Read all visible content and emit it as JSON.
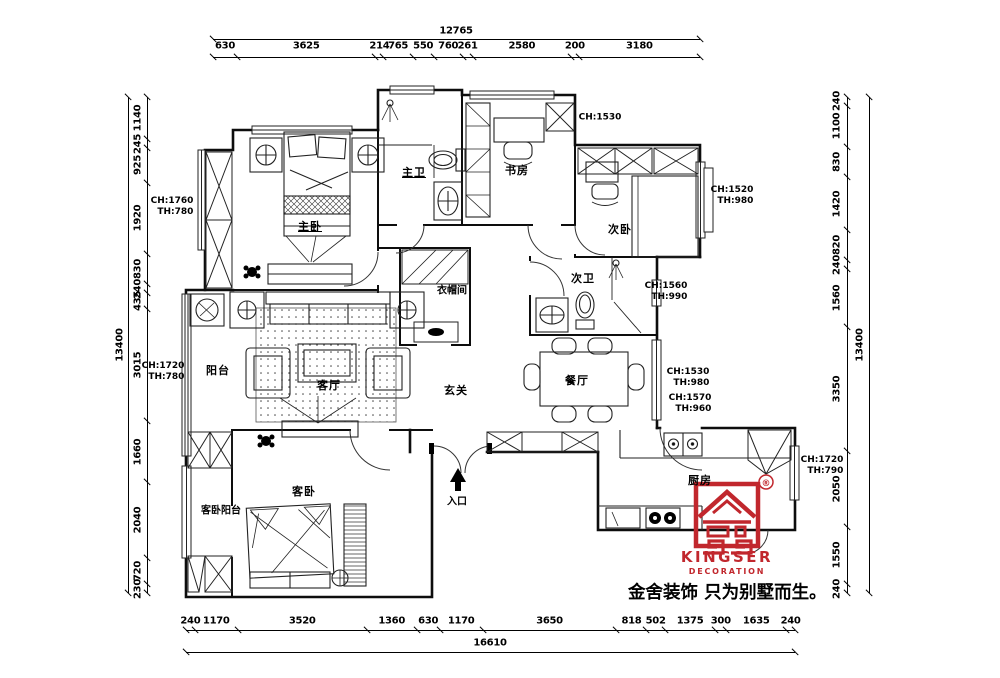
{
  "drawing": {
    "type": "residential floor plan",
    "units": "mm"
  },
  "rooms": {
    "master_bedroom": "主卧",
    "master_bath": "主卫",
    "study": "书房",
    "second_bedroom": "次卧",
    "cloakroom": "衣帽间",
    "second_bath": "次卫",
    "balcony": "阳台",
    "living_room": "客厅",
    "foyer": "玄关",
    "dining_room": "餐厅",
    "guest_bedroom": "客卧",
    "guest_bedroom_balcony": "客卧阳台",
    "kitchen": "厨房",
    "entrance": "入口"
  },
  "annotations": {
    "a1": {
      "l1": "CH:1760",
      "l2": "TH:780"
    },
    "a2": {
      "l1": "CH:1530",
      "l2": ""
    },
    "a3": {
      "l1": "CH:1520",
      "l2": "TH:980"
    },
    "a4": {
      "l1": "CH:1560",
      "l2": "TH:990"
    },
    "a5": {
      "l1": "CH:1530",
      "l2": "TH:980"
    },
    "a6": {
      "l1": "CH:1570",
      "l2": "TH:960"
    },
    "a7": {
      "l1": "CH:1720",
      "l2": "TH:780"
    },
    "a8": {
      "l1": "CH:1720",
      "l2": "TH:790"
    }
  },
  "dimensions": {
    "top": {
      "total": "12765",
      "segments": [
        630,
        3625,
        214,
        765,
        550,
        760,
        261,
        2580,
        200,
        3180
      ]
    },
    "left": {
      "total": "13400",
      "segments": [
        1140,
        245,
        925,
        1920,
        830,
        240,
        435,
        3015,
        1660,
        2040,
        720,
        230
      ]
    },
    "right": {
      "total": "13400",
      "segments": [
        240,
        1100,
        830,
        1420,
        820,
        240,
        1560,
        3350,
        2050,
        1550,
        240
      ]
    },
    "bottom": {
      "total": "16610",
      "segments": [
        240,
        1170,
        3520,
        1360,
        630,
        1170,
        3650,
        818,
        502,
        1375,
        300,
        1635,
        240
      ]
    }
  },
  "branding": {
    "name": "KINGSER",
    "subtitle": "DECORATION",
    "registered": "®",
    "tagline": "金舍装饰 只为别墅而生。",
    "color": "#c1272d"
  }
}
